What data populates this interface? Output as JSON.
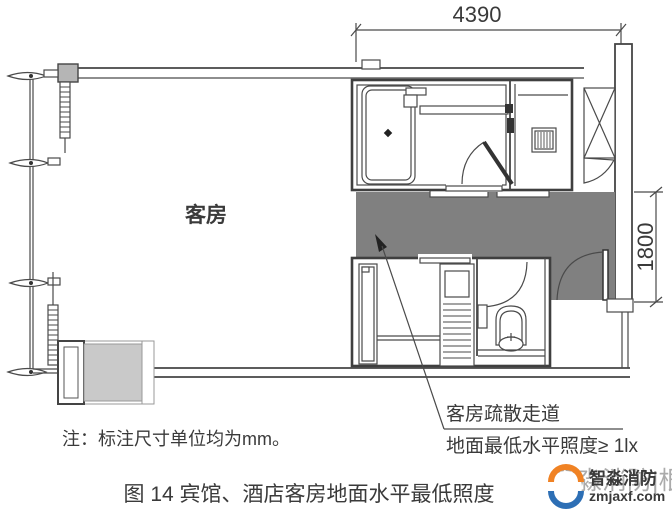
{
  "figure": {
    "caption": "图 14 宾馆、酒店客房地面水平最低照度",
    "note": "注：标注尺寸单位均为mm。"
  },
  "plan": {
    "room_label": "客房",
    "dim_width": "4390",
    "dim_height": "1800",
    "callout_line1": "客房疏散走道",
    "callout_line2": "地面最低水平照度≥ 1lx"
  },
  "watermark": {
    "ghost": "智淼消防|根",
    "brand": "智淼消防",
    "site": "zmjaxf.com"
  },
  "colors": {
    "corridor": "#808080",
    "mattress": "#c9c9c9",
    "column": "#b5b5b5",
    "brand_orange": "#f08224",
    "brand_blue": "#2d6fb5"
  }
}
